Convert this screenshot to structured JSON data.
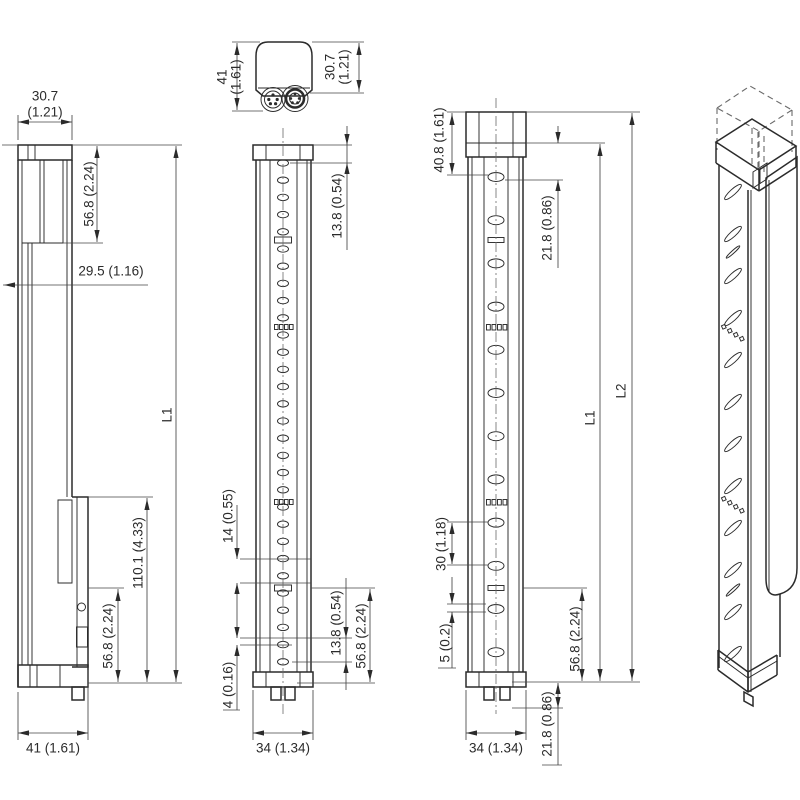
{
  "meta": {
    "description": "Technical dimensional drawing of a safety light curtain (4 orthographic views and 1 isometric view)",
    "background": "#ffffff",
    "line_color": "#2b2b2b",
    "text_color": "#2b2b2b"
  },
  "views": {
    "side_view": {
      "name": "side profile view",
      "dims": {
        "width_top": {
          "value": "30.7",
          "inch": "(1.21)",
          "label": "30.7 (1.21)"
        },
        "height_top": {
          "label": "56.8 (2.24)"
        },
        "depth": {
          "label": "29.5 (1.16)"
        },
        "length": {
          "label": "L1"
        },
        "height_connector": {
          "label": "110.1 (4.33)"
        },
        "height_bottom": {
          "label": "56.8 (2.24)"
        },
        "width_bottom": {
          "label": "41 (1.61)"
        }
      }
    },
    "end_view": {
      "name": "top end view with M12 connectors",
      "dims": {
        "height": {
          "value": "41",
          "inch": "(1.61)",
          "label": "41 (1.61)"
        },
        "width": {
          "value": "30.7",
          "inch": "(1.21)",
          "label": "30.7 (1.21)"
        }
      }
    },
    "front_view_a": {
      "name": "front view, fine beam pitch",
      "dims": {
        "first_beam": {
          "label": "13.8 (0.54)"
        },
        "beam_gap": {
          "label": "14 (0.55)"
        },
        "edge_gap": {
          "label": "4 (0.16)"
        },
        "last_beam": {
          "label": "13.8 (0.54)"
        },
        "bottom_section": {
          "label": "56.8 (2.24)"
        },
        "width": {
          "label": "34 (1.34)"
        }
      }
    },
    "front_view_b": {
      "name": "front view, coarse beam pitch",
      "dims": {
        "cap_height": {
          "label": "40.8 (1.61)"
        },
        "first_beam": {
          "label": "21.8 (0.86)"
        },
        "beam_pitch": {
          "label": "30 (1.18)"
        },
        "slit": {
          "label": "5 (0.2)"
        },
        "bottom_section": {
          "label": "56.8 (2.24)"
        },
        "length_housing": {
          "label": "L1"
        },
        "length_total": {
          "label": "L2"
        },
        "bottom_offset": {
          "label": "21.8 (0.86)"
        },
        "width": {
          "label": "34 (1.34)"
        }
      }
    },
    "iso_view": {
      "name": "isometric view with detached end cap (dashed)"
    }
  },
  "geometry": {
    "beams_front_a": {
      "cx": 283,
      "rx": 5.5,
      "ry": 3.2,
      "y_start": 163,
      "pitch": 17.2,
      "count": 30
    },
    "beams_front_b": {
      "cx": 496,
      "rx": 8,
      "ry": 4.5,
      "y_start": 177,
      "pitch": 43.2,
      "count": 12
    },
    "beams_iso": {
      "cx": 733,
      "rx": 11,
      "ry": 2.8,
      "y_start": 192,
      "pitch": 42,
      "count": 12,
      "tilt": -42
    }
  }
}
